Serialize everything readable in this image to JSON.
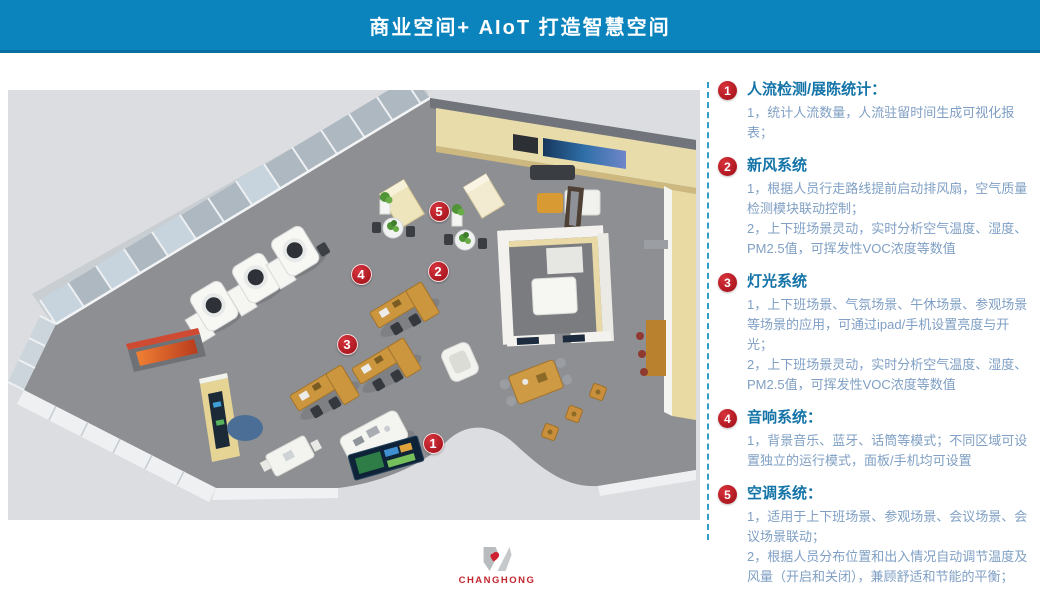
{
  "header": {
    "title": "商业空间+ AIoT 打造智慧空间"
  },
  "colors": {
    "header_bg": "#0b83bd",
    "marker_red": "#b5161f",
    "heading_blue": "#1474a8",
    "body_blue": "#7f9fc4",
    "separator_blue": "#2f9dc4",
    "brand_red": "#c3272e"
  },
  "floor_plan": {
    "description": "3d-isometric-office-showroom",
    "markers": [
      {
        "num": "1",
        "x": 425,
        "y": 353
      },
      {
        "num": "2",
        "x": 430,
        "y": 181
      },
      {
        "num": "3",
        "x": 339,
        "y": 254
      },
      {
        "num": "4",
        "x": 353,
        "y": 184
      },
      {
        "num": "5",
        "x": 431,
        "y": 121
      }
    ]
  },
  "panel": {
    "items": [
      {
        "num": "1",
        "title": "人流检测/展陈统计：",
        "lines": [
          "1，统计人流数量，人流驻留时间生成可视化报表；"
        ]
      },
      {
        "num": "2",
        "title": "新风系统",
        "lines": [
          "1，根据人员行走路线提前启动排风扇，空气质量检测模块联动控制；",
          "2，上下班场景灵动，实时分析空气温度、湿度、PM2.5值，可挥发性VOC浓度等数值"
        ]
      },
      {
        "num": "3",
        "title": "灯光系统",
        "lines": [
          "1，上下班场景、气氛场景、午休场景、参观场景等场景的应用，可通过ipad/手机设置亮度与开光；",
          "2，上下班场景灵动，实时分析空气温度、湿度、PM2.5值，可挥发性VOC浓度等数值"
        ]
      },
      {
        "num": "4",
        "title": "音响系统：",
        "lines": [
          "1，背景音乐、蓝牙、话筒等模式；不同区域可设置独立的运行模式，面板/手机均可设置"
        ]
      },
      {
        "num": "5",
        "title": "空调系统：",
        "lines": [
          "1，适用于上下班场景、参观场景、会议场景、会议场景联动；",
          "2，根据人员分布位置和出入情况自动调节温度及风量（开启和关闭），兼顾舒适和节能的平衡；"
        ]
      }
    ]
  },
  "footer": {
    "brand": "CHANGHONG"
  }
}
